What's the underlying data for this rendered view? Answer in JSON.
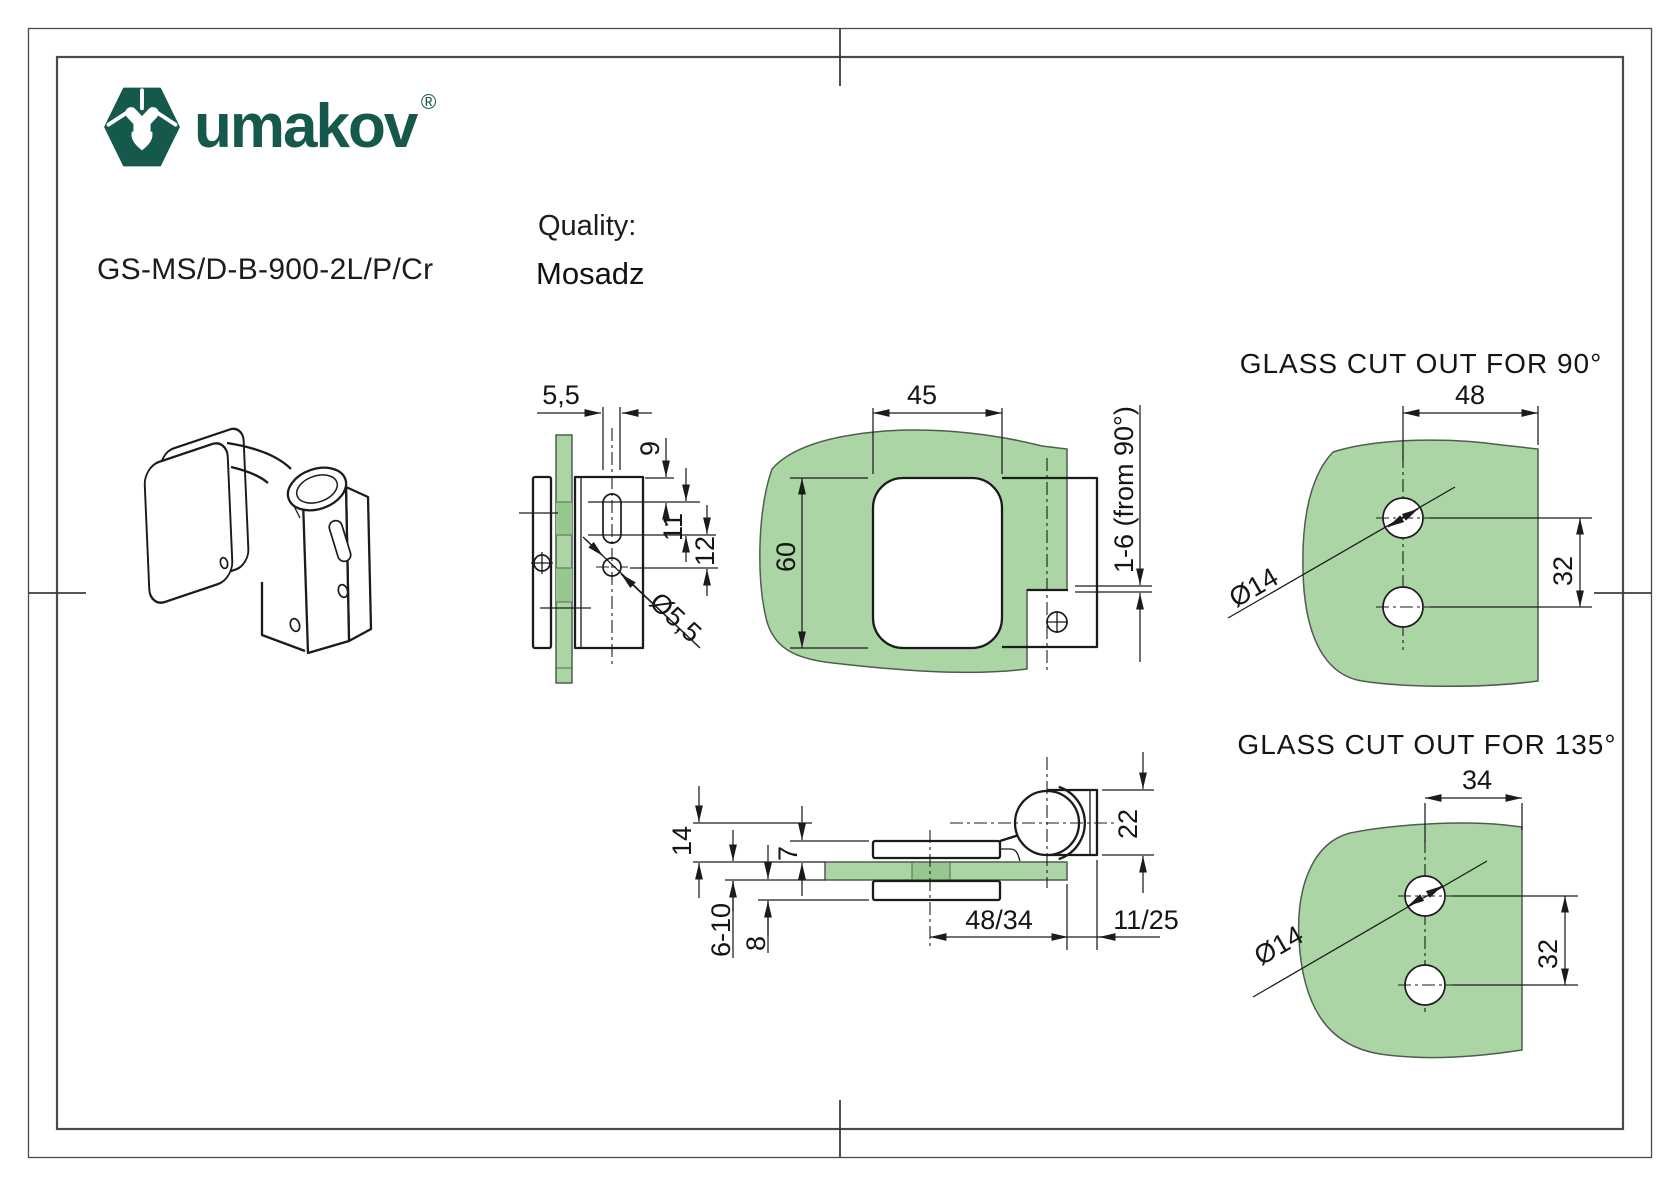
{
  "brand": {
    "name": "umakov",
    "registered_mark": "®",
    "logo_color": "#14594b"
  },
  "product_code": "GS-MS/D-B-900-2L/P/Cr",
  "quality": {
    "label": "Quality:",
    "value": "Mosadz"
  },
  "colors": {
    "glass": "#abd5a5",
    "glass_dark": "#95c78f",
    "line": "#1b1b1b",
    "brand_green": "#14594b"
  },
  "views": {
    "side": {
      "dims": {
        "plate_offset": "5,5",
        "top_to_slot": "9",
        "slot_length": "11",
        "slot_to_hole": "12",
        "hole_diameter": "Ø5,5"
      }
    },
    "front": {
      "dims": {
        "width": "45",
        "height": "60",
        "adjustment": "1-6 (from 90°)"
      }
    },
    "cutout90": {
      "title": "GLASS CUT OUT FOR 90°",
      "dims": {
        "edge_distance": "48",
        "hole_spacing": "32",
        "hole_diameter": "Ø14"
      }
    },
    "horizontal_section": {
      "dims": {
        "hinge_offset": "14",
        "plate_thickness": "7",
        "glass_thickness": "6-10",
        "back_plate": "8",
        "glass_depth": "48/34",
        "edge_offset": "11/25",
        "knuckle_width": "22"
      }
    },
    "cutout135": {
      "title": "GLASS CUT OUT FOR 135°",
      "dims": {
        "edge_distance": "34",
        "hole_spacing": "32",
        "hole_diameter": "Ø14"
      }
    }
  }
}
